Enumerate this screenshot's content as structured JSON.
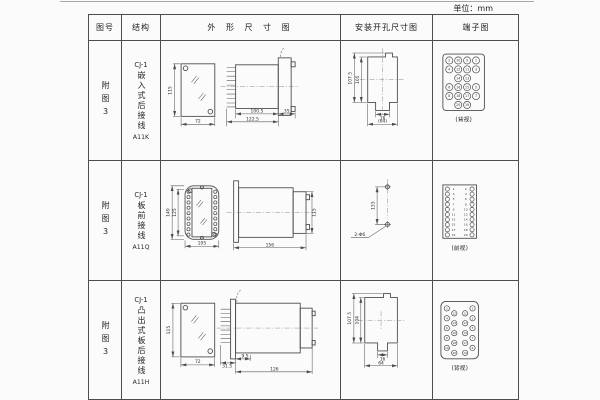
{
  "page": {
    "unit_note": "单位：mm"
  },
  "table": {
    "headers": {
      "fig_no": "图号",
      "structure": "结构",
      "outline": "外 形 尺 寸 图",
      "mounting": "安装开孔尺寸图",
      "terminal": "端子图"
    },
    "rows": [
      {
        "fig_no": "附图3",
        "model": "CJ-1",
        "structure": "嵌入式后接线",
        "code": "A11K",
        "outline": {
          "front_h": "115",
          "front_w": "72",
          "body_len": "100.5",
          "total_len": "122.5",
          "flange_len": "35"
        },
        "mounting": {
          "outer_h": "107.5",
          "inner_h": "105",
          "tab_w": "16",
          "outer_w": "(64)"
        },
        "terminal": {
          "view": "(背视)",
          "numbers": [
            [
              2,
              10,
              9,
              1
            ],
            [
              4,
              12,
              11,
              3
            ],
            [
              14,
              13
            ],
            [
              6,
              16,
              15,
              5
            ],
            [
              8,
              18,
              17,
              7
            ],
            [
              20,
              19
            ]
          ]
        }
      },
      {
        "fig_no": "附图3",
        "model": "CJ-1",
        "structure": "板前接线",
        "code": "A11Q",
        "outline": {
          "front_outer_h": "149",
          "front_inner_h": "125",
          "front_w": "105",
          "side_len": "156",
          "side_h": "115"
        },
        "mounting": {
          "hole_pitch": "133",
          "hole_label": "2-Φ6"
        },
        "terminal": {
          "view": "(前视)",
          "left": [
            1,
            3,
            5,
            7,
            9,
            11,
            13,
            15,
            17,
            19
          ],
          "right": [
            2,
            4,
            6,
            8,
            10,
            12,
            14,
            16,
            18,
            20
          ]
        }
      },
      {
        "fig_no": "附图3",
        "model": "CJ-1",
        "structure": "凸出式板后接线",
        "code": "A11H",
        "outline": {
          "front_h": "115",
          "front_w": "72",
          "comb_len": "31.5",
          "inset": "9.5",
          "body_len": "126"
        },
        "mounting": {
          "outer_h": "107.5",
          "inner_h": "104",
          "tab_w": "16",
          "outer_w": "64"
        },
        "terminal": {
          "view": "(背视)",
          "left_outer": [
            2,
            4,
            6,
            8,
            10
          ],
          "left_inner": [
            12,
            14,
            16,
            18,
            20
          ],
          "right_inner": [
            11,
            13,
            15,
            17,
            19
          ],
          "right_outer": [
            1,
            3,
            5,
            7,
            9
          ]
        }
      }
    ]
  }
}
